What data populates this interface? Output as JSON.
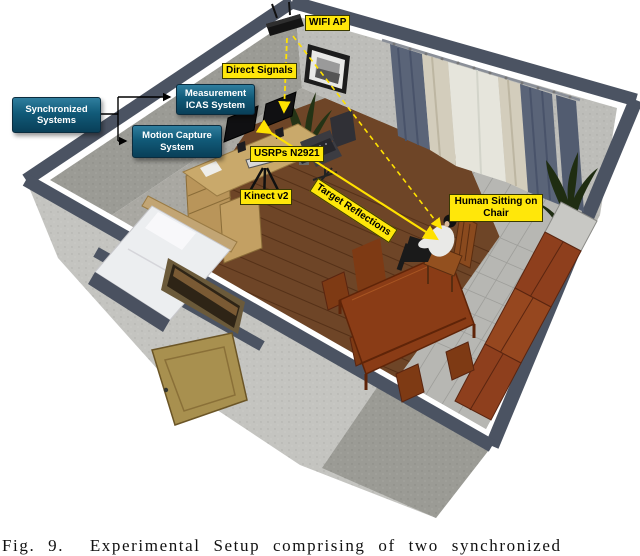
{
  "figure": {
    "caption": "Fig. 9.  Experimental Setup comprising of two synchronized",
    "flow_boxes": {
      "synchronized": "Synchronized\nSystems",
      "measurement": "Measurement\nICAS System",
      "motion_capture": "Motion Capture\nSystem"
    },
    "annotations": {
      "wifi_ap": "WIFI AP",
      "direct_signals": "Direct Signals",
      "usrps": "USRPs N2921",
      "kinect": "Kinect v2",
      "target_reflections": "Target Reflections",
      "human": "Human Sitting on\nChair"
    },
    "colors": {
      "annotation_bg": "#ffe70a",
      "annotation_text": "#000000",
      "flow_box_fill": "#115a78",
      "flow_box_text": "#ffffff",
      "signal_line": "#ffe100",
      "connector_line": "#000000",
      "wall_band": "#4b5362",
      "wood_floor": "#6e4527",
      "tile_floor": "#b7b7b3",
      "carpet": "#a9a8a2",
      "cabinet_wood": "#8e3f1d"
    }
  }
}
